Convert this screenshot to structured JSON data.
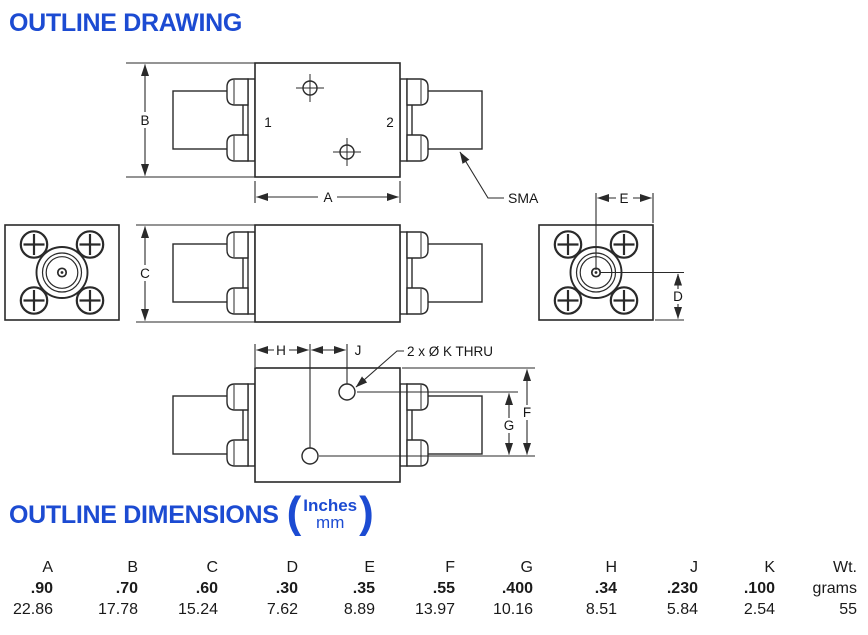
{
  "page": {
    "drawing_title": "OUTLINE DRAWING",
    "dimensions_title": "OUTLINE DIMENSIONS",
    "units_top": "Inches",
    "units_bottom": "mm"
  },
  "drawing": {
    "labels": {
      "dim_a": "A",
      "dim_b": "B",
      "dim_c": "C",
      "dim_d": "D",
      "dim_e": "E",
      "dim_f": "F",
      "dim_g": "G",
      "dim_h": "H",
      "dim_j": "J",
      "port1": "1",
      "port2": "2",
      "connector_type": "SMA",
      "hole_note": "2 x Ø K THRU"
    }
  },
  "table": {
    "columns": [
      "A",
      "B",
      "C",
      "D",
      "E",
      "F",
      "G",
      "H",
      "J",
      "K",
      "Wt."
    ],
    "inches": [
      ".90",
      ".70",
      ".60",
      ".30",
      ".35",
      ".55",
      ".400",
      ".34",
      ".230",
      ".100",
      "grams"
    ],
    "mm": [
      "22.86",
      "17.78",
      "15.24",
      "7.62",
      "8.89",
      "13.97",
      "10.16",
      "8.51",
      "5.84",
      "2.54",
      "55"
    ]
  },
  "colors": {
    "accent_blue": "#1c4bd2",
    "line": "#2a2a2a"
  }
}
